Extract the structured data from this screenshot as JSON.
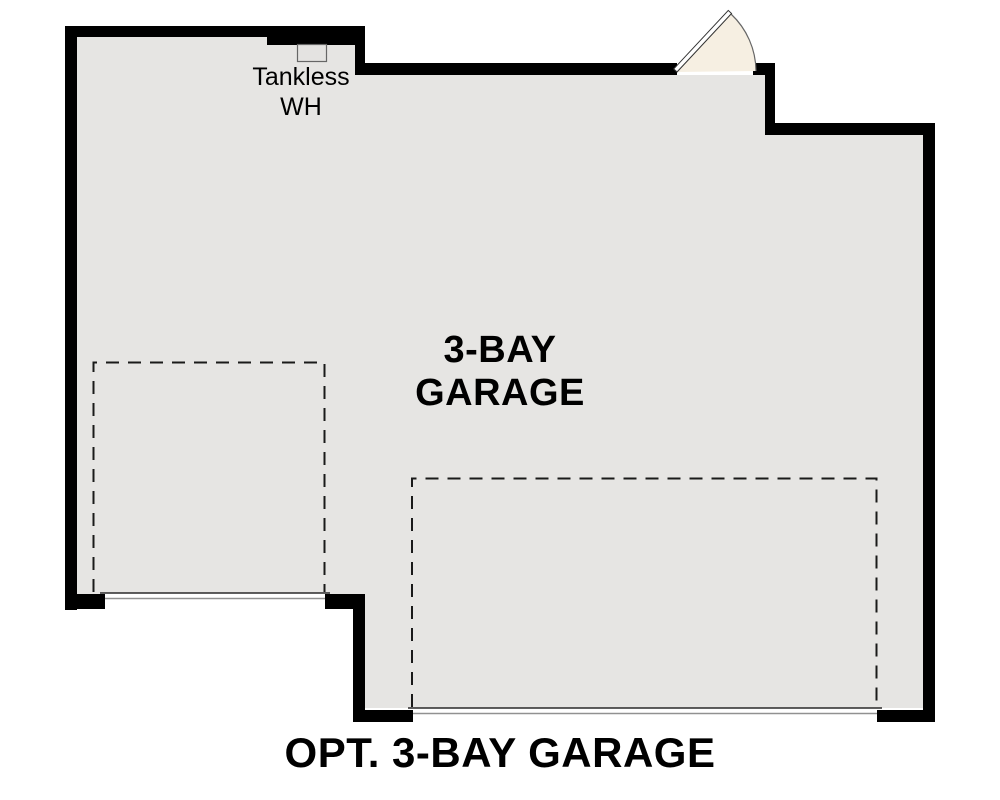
{
  "plan": {
    "title": "OPT. 3-BAY GARAGE",
    "room": {
      "name_line1": "3-BAY",
      "name_line2": "GARAGE"
    },
    "water_heater": {
      "line1": "Tankless",
      "line2": "WH"
    }
  },
  "colors": {
    "floor": "#e6e5e3",
    "wall": "#000000",
    "door_fan": "#f6efe2",
    "wh_box": "#e4e3e1",
    "text": "#000000",
    "dashed_line": "#1a1a1a",
    "garage_door_top_line": "#2a2a2a",
    "garage_door_bottom_line": "#919191"
  }
}
